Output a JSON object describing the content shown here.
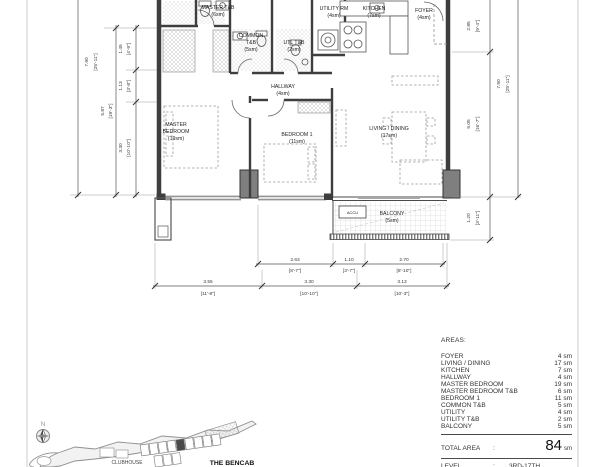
{
  "rooms": {
    "master_tb": {
      "l1": "MASTER T&B",
      "l2": "(6sm)"
    },
    "common_tb": {
      "l1": "COMMON",
      "l2": "T&B",
      "l3": "(5sm)"
    },
    "utl_tb": {
      "l1": "UTL T&B",
      "l2": "(2sm)"
    },
    "utility_rm": {
      "l1": "UTILITY RM",
      "l2": "(4sm)"
    },
    "kitchen": {
      "l1": "KITCHEN",
      "l2": "(7sm)"
    },
    "foyer": {
      "l1": "FOYER",
      "l2": "(4sm)"
    },
    "hallway": {
      "l1": "HALLWAY",
      "l2": "(4sm)"
    },
    "master_bedroom": {
      "l1": "MASTER",
      "l2": "BEDROOM",
      "l3": "(19sm)"
    },
    "bedroom1": {
      "l1": "BEDROOM 1",
      "l2": "(11sm)"
    },
    "living_dining": {
      "l1": "LIVING / DINING",
      "l2": "(17sm)"
    },
    "balcony": {
      "l1": "BALCONY",
      "l2": "(5sm)"
    },
    "accu": {
      "l1": "ACCU"
    }
  },
  "dims": {
    "left": {
      "outer": {
        "m": "7.90",
        "ft": "[25'-11\"]"
      },
      "mid": {
        "m": "5.87",
        "ft": "[19'-3\"]"
      },
      "inner": [
        {
          "m": "1.45",
          "ft": "[4'-9\"]"
        },
        {
          "m": "1.13",
          "ft": "[3'-8\"]"
        },
        {
          "m": "3.30",
          "ft": "[10'-10\"]"
        }
      ]
    },
    "right": {
      "outer": {
        "m": "7.90",
        "ft": "[25'-11\"]"
      },
      "inner": [
        {
          "m": "2.85",
          "ft": "[9'-4\"]"
        },
        {
          "m": "5.05",
          "ft": "[16'-7\"]"
        },
        {
          "m": "1.20",
          "ft": "[3'-11\"]"
        }
      ]
    },
    "bottom_upper": [
      {
        "m": "2.63",
        "ft": "[8'-7\"]"
      },
      {
        "m": "1.10",
        "ft": "[3'-7\"]"
      },
      {
        "m": "2.70",
        "ft": "[8'-10\"]"
      }
    ],
    "bottom_lower": [
      {
        "m": "3.55",
        "ft": "[11'-8\"]"
      },
      {
        "m": "3.30",
        "ft": "[10'-10\"]"
      },
      {
        "m": "3.13",
        "ft": "[10'-3\"]"
      }
    ]
  },
  "areas": {
    "title": "AREAS:",
    "rows": [
      {
        "label": "FOYER",
        "value": "4 sm"
      },
      {
        "label": "LIVING / DINING",
        "value": "17 sm"
      },
      {
        "label": "KITCHEN",
        "value": "7 sm"
      },
      {
        "label": "HALLWAY",
        "value": "4 sm"
      },
      {
        "label": "MASTER BEDROOM",
        "value": "19 sm"
      },
      {
        "label": "MASTER BEDROOM T&B",
        "value": "6 sm"
      },
      {
        "label": "BEDROOM 1",
        "value": "11 sm"
      },
      {
        "label": "COMMON T&B",
        "value": "5 sm"
      },
      {
        "label": "UTILITY",
        "value": "4 sm"
      },
      {
        "label": "UTILITY T&B",
        "value": "2 sm"
      },
      {
        "label": "BALCONY",
        "value": "5 sm"
      }
    ],
    "total": {
      "label": "TOTAL AREA",
      "sep": ":",
      "value": "84",
      "unit": "sm"
    },
    "level": {
      "label": "LEVEL",
      "sep": ":",
      "value": "3RD-17TH"
    }
  },
  "site": {
    "north_label": "N",
    "clubhouse_label": "CLUBHOUSE",
    "building_label": "THE BENCAB"
  },
  "colors": {
    "wall": "#3e3e3e",
    "column_fill": "#7f7f7f",
    "dim_line": "#555555",
    "page_border": "#cccccc"
  }
}
